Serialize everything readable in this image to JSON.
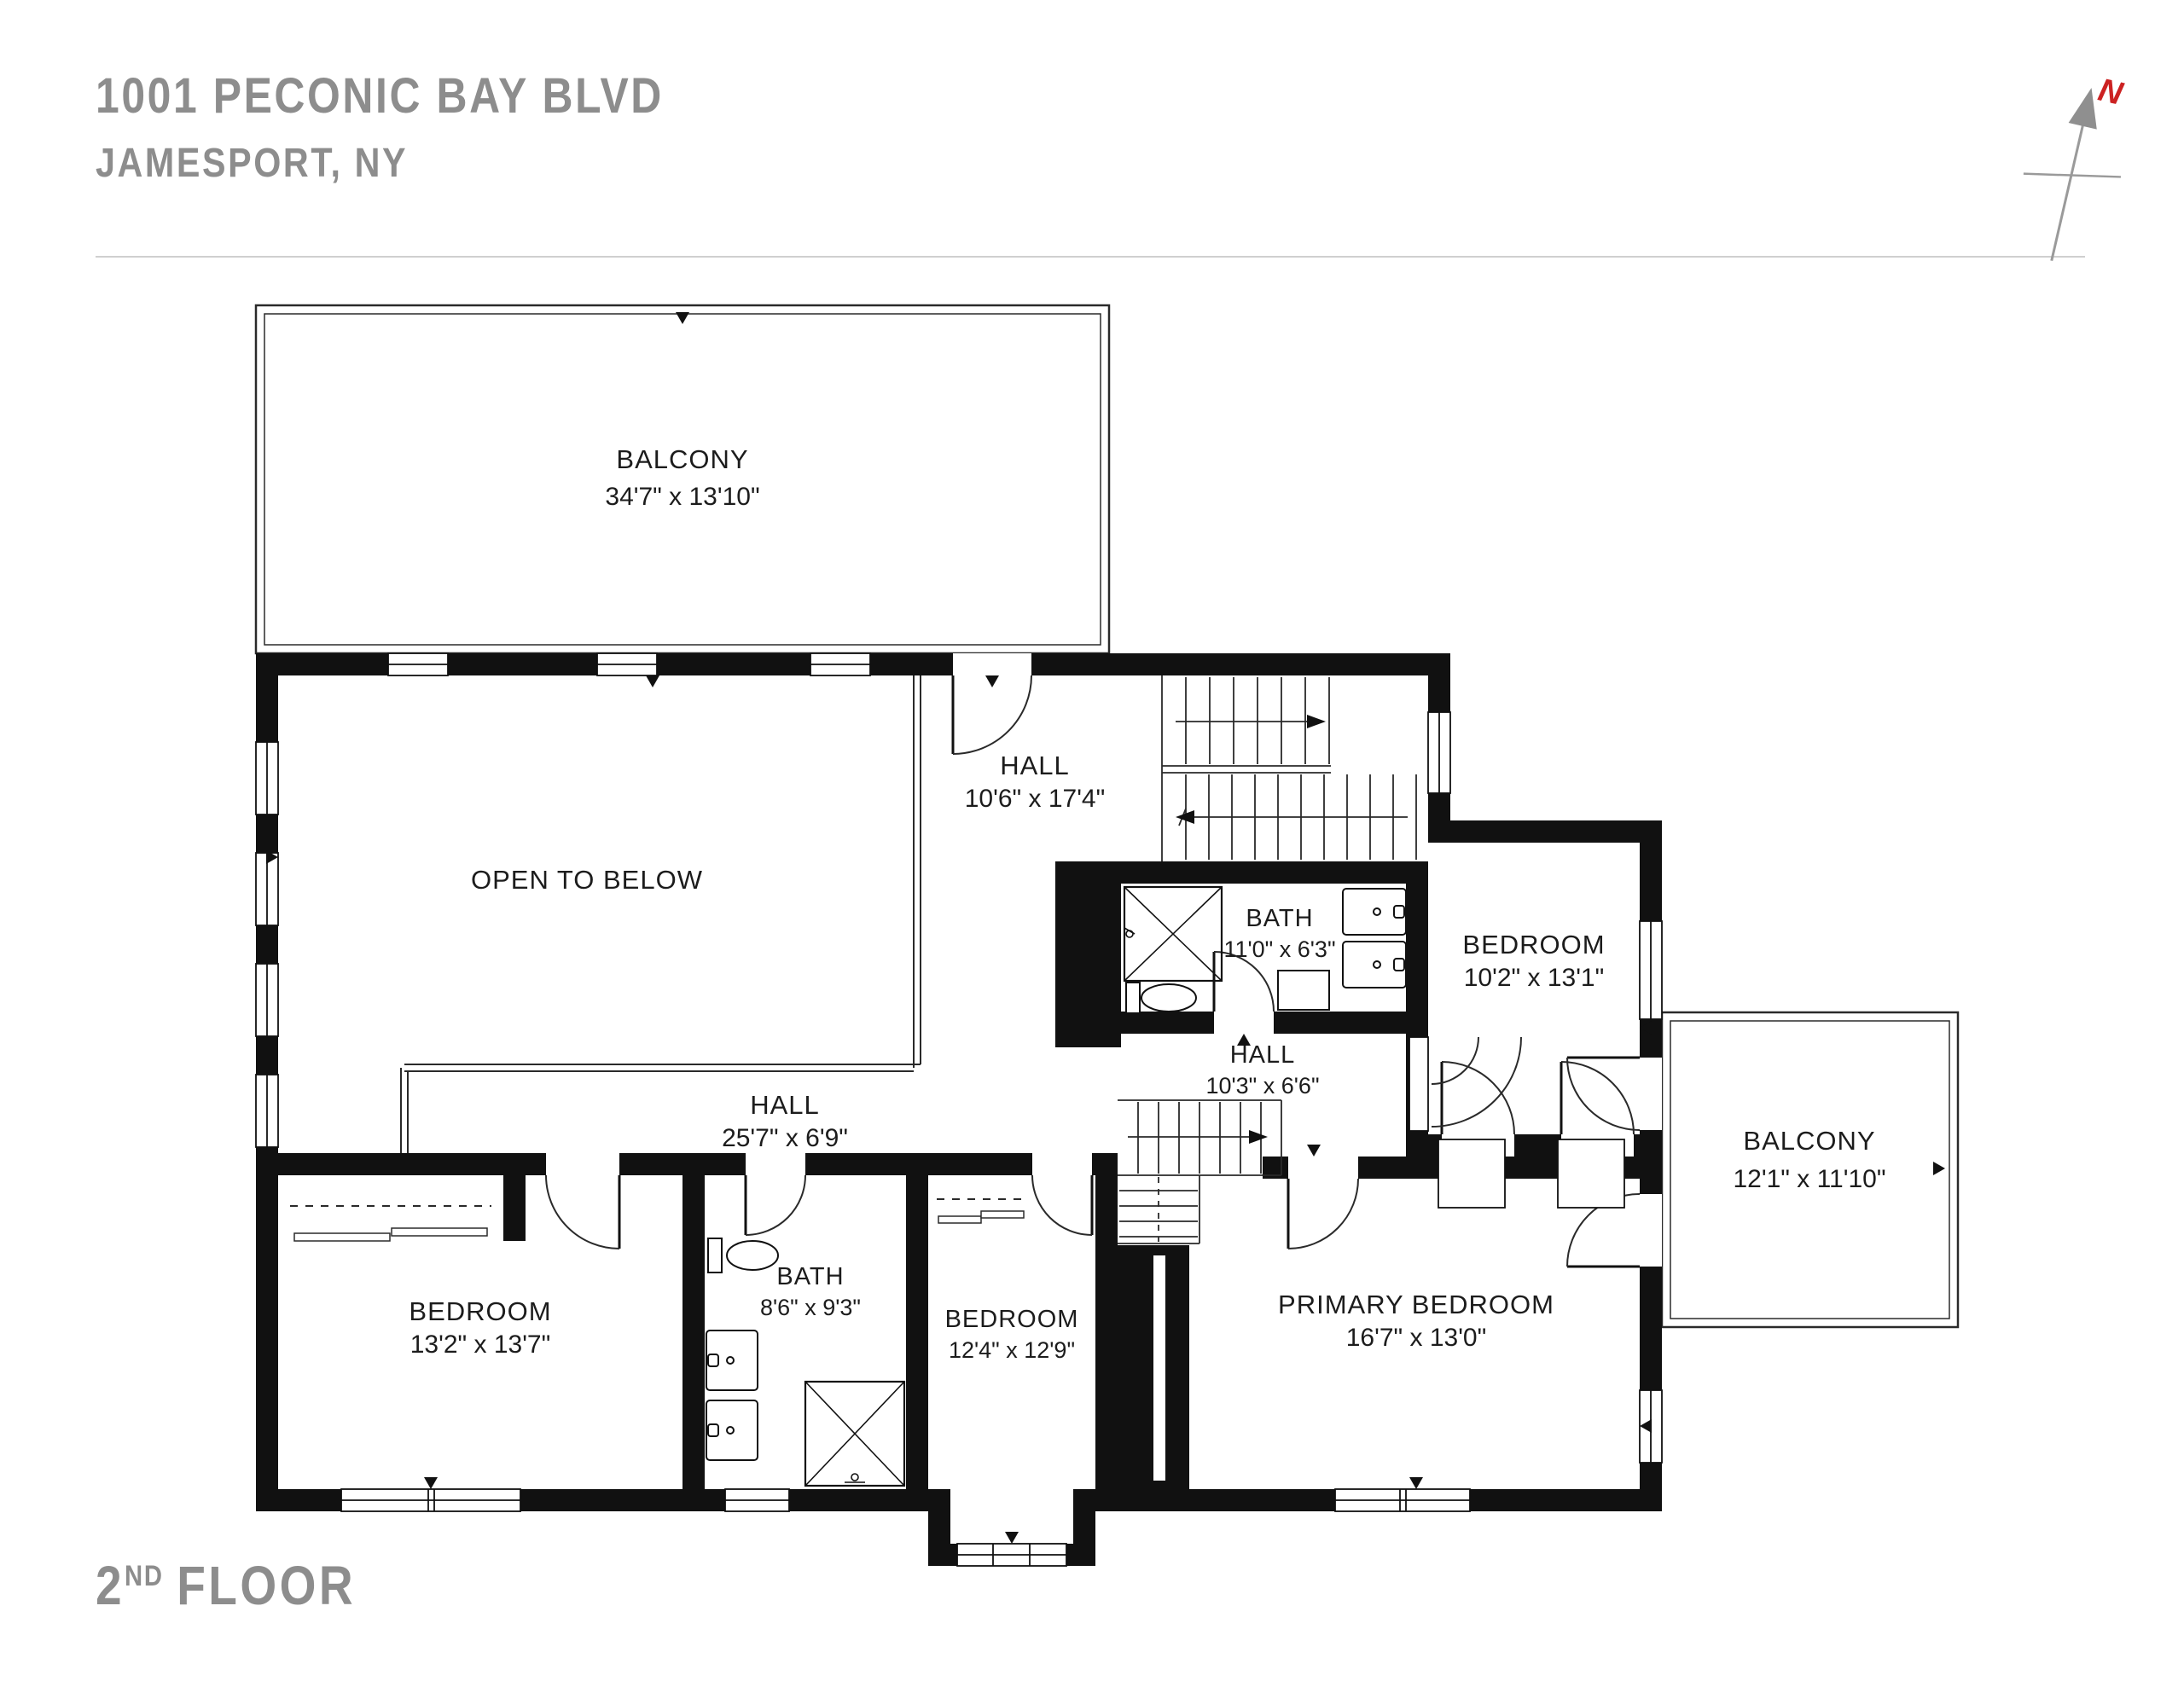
{
  "header": {
    "address_line1": "1001 PECONIC BAY BLVD",
    "address_line2": "JAMESPORT, NY"
  },
  "floor_label": {
    "number": "2",
    "ordinal": "ND",
    "text": "FLOOR"
  },
  "compass": {
    "north_label": "N"
  },
  "colors": {
    "wall": "#111111",
    "label_gray": "#8d8d8d",
    "north_red": "#cc2222",
    "line": "#2a2a2a"
  },
  "rooms": {
    "balcony_top": {
      "name": "BALCONY",
      "dims": "34'7\" x 13'10\""
    },
    "hall_upper": {
      "name": "HALL",
      "dims": "10'6\" x 17'4\""
    },
    "open_to_below": {
      "name": "OPEN TO BELOW"
    },
    "bath_upper": {
      "name": "BATH",
      "dims": "11'0\" x 6'3\""
    },
    "bedroom_ne": {
      "name": "BEDROOM",
      "dims": "10'2\" x 13'1\""
    },
    "hall_middle": {
      "name": "HALL",
      "dims": "10'3\" x 6'6\""
    },
    "balcony_right": {
      "name": "BALCONY",
      "dims": "12'1\" x 11'10\""
    },
    "hall_lower": {
      "name": "HALL",
      "dims": "25'7\" x 6'9\""
    },
    "bedroom_left": {
      "name": "BEDROOM",
      "dims": "13'2\" x 13'7\""
    },
    "bath_lower": {
      "name": "BATH",
      "dims": "8'6\" x 9'3\""
    },
    "bedroom_middle": {
      "name": "BEDROOM",
      "dims": "12'4\" x 12'9\""
    },
    "primary_bedroom": {
      "name": "PRIMARY BEDROOM",
      "dims": "16'7\" x 13'0\""
    }
  }
}
